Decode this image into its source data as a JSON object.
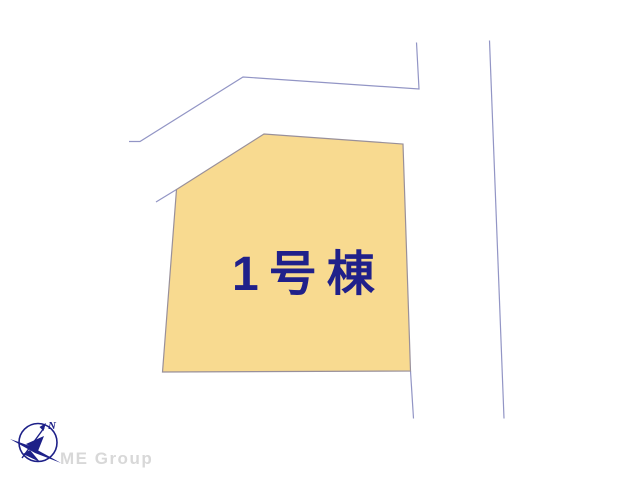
{
  "map": {
    "parcel": {
      "label": "1号棟",
      "fill_color": "#F8DA90",
      "outline_color": "#99909A",
      "label_color": "#20208A",
      "points": "176.5,189.5 264,134 403,144 410.5,371 162.5,372"
    },
    "roads": {
      "line_color": "#9295C5",
      "polylines": [
        {
          "name": "road-upper-boundary",
          "points": "129,141.5 140,141.5 243,77 419,89 416.5,42.5"
        },
        {
          "name": "road-right-boundary",
          "points": "489.5,40.5 504,418.5"
        },
        {
          "name": "road-edge-below-parcel",
          "points": "410.5,371 413.5,418.5"
        },
        {
          "name": "road-edge-left-of-parcel",
          "points": "176.5,189.5 156,202"
        }
      ]
    }
  },
  "compass": {
    "north_label": "N",
    "color": "#1D2088"
  },
  "branding": {
    "company": "ME Group",
    "text_color": "#D8D8D8"
  }
}
